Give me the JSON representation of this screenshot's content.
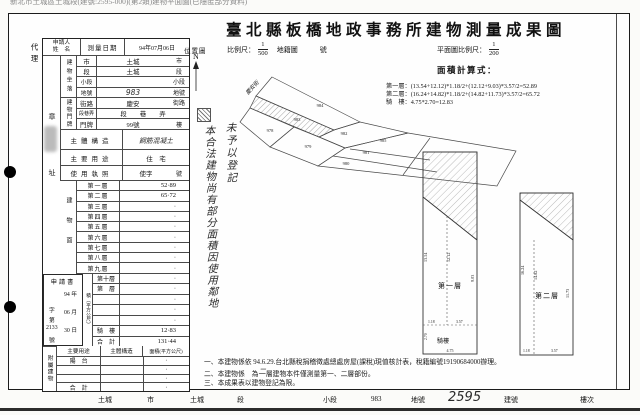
{
  "page": {
    "top_text": "新北市土城區土城段(建號:2595-000)(第2類)建物平面圖(已隱匿部分資料)",
    "title": "臺北縣板橋地政事務所建物測量成果圖"
  },
  "head": {
    "agent": "代理",
    "applicant1": "申請人",
    "applicant2": "姓　名",
    "survey_label": "測量日期",
    "survey_value": "94年07月06日",
    "seal": "章",
    "addr": "址"
  },
  "loc": {
    "spine": "建物坐落",
    "r1l": "市",
    "r1v": "土城",
    "r1s": "市",
    "r2l": "段",
    "r2v": "土城",
    "r2s": "段",
    "r3l": "小段",
    "r3v": "",
    "r3s": "小段",
    "r4l": "地號",
    "r4v": "983",
    "r4s": "地號"
  },
  "door": {
    "spine": "建物門牌",
    "r1l": "街路",
    "r1v": "慶安",
    "r1s": "街路",
    "r2l": "段巷弄",
    "r2v": "段　　巷　　弄",
    "r3l": "門牌",
    "r3v": "99號",
    "r3s": "樓"
  },
  "mid": {
    "structure_l": "主體構造",
    "structure_v": "鋼筋混凝土",
    "usage_l": "主要用途",
    "usage_v": "住　宅",
    "license_l": "使用執照",
    "license_v": "使字",
    "license_s": "號"
  },
  "area": {
    "spine_top": "建物面",
    "spine_bottom": "積（平方公尺）",
    "rows_a": [
      {
        "label": "第一層",
        "value": "52·89"
      },
      {
        "label": "第二層",
        "value": "65·72"
      },
      {
        "label": "第三層",
        "value": "·"
      },
      {
        "label": "第四層",
        "value": "·"
      },
      {
        "label": "第五層",
        "value": "·"
      },
      {
        "label": "第六層",
        "value": "·"
      },
      {
        "label": "第七層",
        "value": "·"
      },
      {
        "label": "第八層",
        "value": "·"
      },
      {
        "label": "第九層",
        "value": "·"
      }
    ],
    "rows_b": [
      {
        "label": "第十層",
        "value": "·"
      },
      {
        "label": "第　層",
        "value": "·"
      },
      {
        "label": "",
        "value": "·"
      },
      {
        "label": "",
        "value": "·"
      },
      {
        "label": "",
        "value": "·"
      },
      {
        "label": "騎　樓",
        "value": "12·83"
      },
      {
        "label": "合　計",
        "value": "131·44"
      }
    ]
  },
  "app": {
    "title": "申請書",
    "c1": "字",
    "c2": "第",
    "num": "2133",
    "c3": "號",
    "y": "94",
    "yl": "年",
    "m": "06",
    "ml": "月",
    "d": "30",
    "dl": "日"
  },
  "annex": {
    "spine": "附屬建物",
    "h1": "主要用途",
    "h2": "主體構造",
    "h3": "面積(平方公尺)",
    "rows": [
      {
        "u": "陽　台",
        "s": "",
        "a": "·"
      },
      {
        "u": "",
        "s": "",
        "a": "·"
      },
      {
        "u": "",
        "s": "",
        "a": "·"
      },
      {
        "u": "合　計",
        "s": "",
        "a": "·"
      }
    ]
  },
  "map": {
    "loc_label": "位置圖",
    "north": "N",
    "scale_l": "比例尺：",
    "sn": "1",
    "sd": "500",
    "cad": "地籍圖",
    "no": "號",
    "road": "慶安街",
    "p1": "984",
    "p2": "983",
    "p3": "978",
    "p4": "979",
    "p5": "982",
    "p6": "985",
    "p7": "981",
    "p8": "980",
    "note_right": "未予以登記",
    "note_left": "本合法建物尚有部分面積因使用鄰地"
  },
  "plans": {
    "scale_l": "平面圖比例尺：",
    "sn": "1",
    "sd": "200",
    "calc_title": "面積計算式：",
    "lines": [
      "第一層：(13.54+12.12)*1.18/2+(12.12+9.03)*3.57/2=52.89",
      "第二層：(16.24+14.82)*1.18/2+(14.82+11.73)*3.57/2=65.72",
      "騎　樓：4.75*2.70=12.83"
    ],
    "f1": {
      "label": "第一層",
      "arcade": "騎樓",
      "left": "13.54",
      "inner": "12.12",
      "right": "9.03",
      "seg1": "1.18",
      "seg2": "3.57",
      "width": "4.75",
      "arch": "2.70"
    },
    "f2": {
      "label": "第二層",
      "left": "16.24",
      "inner": "14.82",
      "right": "11.73",
      "seg1": "1.18",
      "seg2": "3.57"
    }
  },
  "notes": {
    "n1": "一、本建物係依 94.6.29.台北縣稅捐稽徵處總處房屋(課稅)現值核計表，稅籍編號19190684000辦理。",
    "n2a": "二、本建物係　為",
    "n2hand": "二",
    "n2b": "層建物本件僅測量第一、二層部份。",
    "n3": "三、本成果表以建物登記為限。"
  },
  "footer": {
    "c1": "土城",
    "l1": "市",
    "c2": "土城",
    "l2": "段",
    "l3": "小段",
    "n1": "983",
    "l4": "地號",
    "hand": "2595",
    "l5": "建號",
    "l6": "樓次"
  }
}
